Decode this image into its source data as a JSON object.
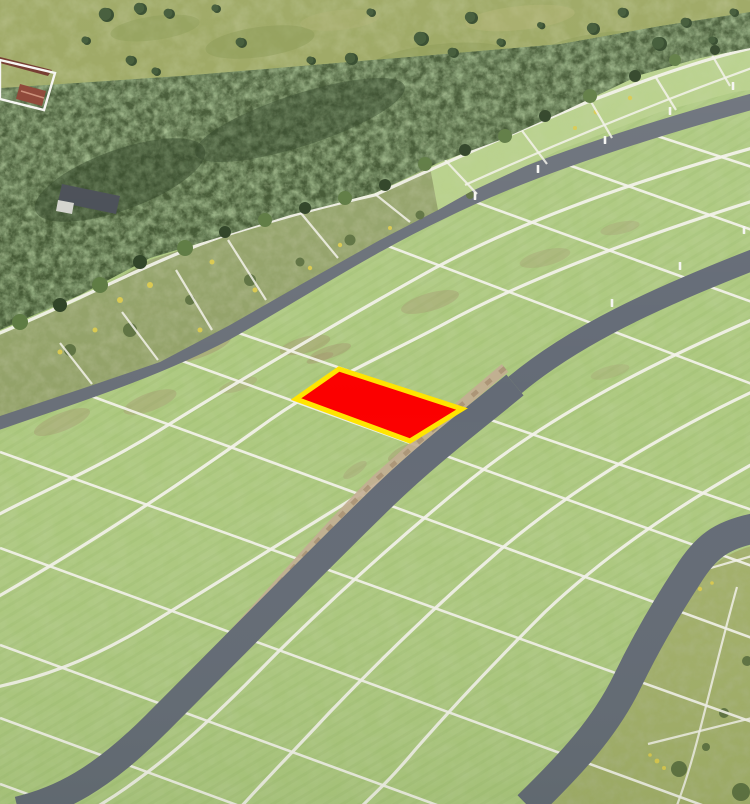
{
  "scene": {
    "description": "Aerial drone photo of a field subdivided into rectangular land plots by white boundary lines and three parallel gray access roads, bordered by a birch forest and meadow at the top; one plot in the center is highlighted solid red with a yellow outline",
    "highlighted_plot": {
      "status": "highlighted",
      "fill": "#fb0000",
      "border": "#ffe400"
    },
    "regions": [
      "meadow-with-trees",
      "farm-buildings",
      "forest-band",
      "overgrown-plots-strip",
      "upper-road",
      "plot-grid-field",
      "highlighted-plot",
      "main-road",
      "lower-road",
      "rough-meadow-corner"
    ]
  },
  "colors": {
    "field": "#adc97f",
    "fieldLight": "#b7d089",
    "fieldStripe": "#8fae62",
    "gridLine": "#f3f2ea",
    "road": "#646b76",
    "roadFar": "#6a7079",
    "dirt": "#c3ad92",
    "dirtDark": "#a28a6c",
    "forest": "#415631",
    "forestLight": "#5d7a41",
    "forestDark": "#2d4124",
    "meadow": "#9aa55e",
    "meadowDark": "#85954e",
    "meadowLight": "#b3b374",
    "scrub": "#93a269",
    "scrubDark": "#5f7342",
    "rough": "#a3b06a",
    "flower": "#d9c94f",
    "post": "#f6f6f2",
    "highlight": "#fb0000",
    "highlightBorder": "#ffe400",
    "roof": "#8a4030",
    "roofDark": "#6e3226",
    "building": "#474c54",
    "buildingLight": "#d2d3cc",
    "tree": "#3c5531",
    "treeDark": "#2e4526"
  }
}
